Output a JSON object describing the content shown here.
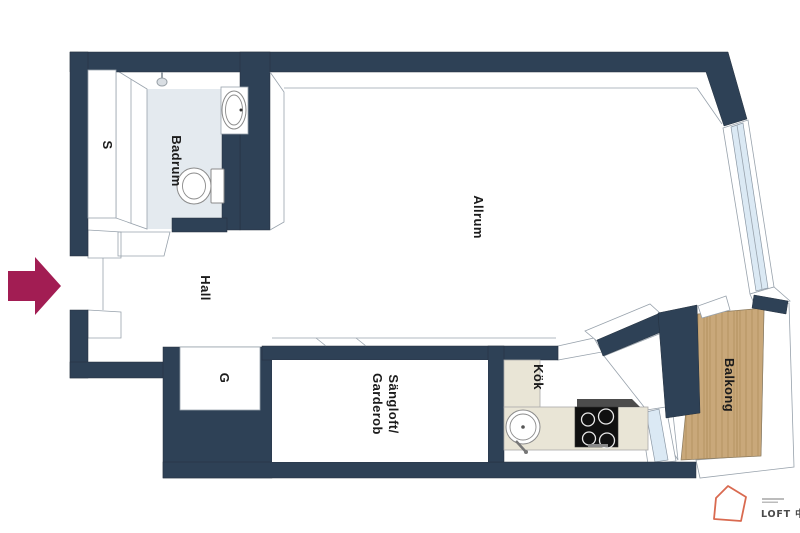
{
  "rooms": {
    "s": {
      "label": "S"
    },
    "badrum": {
      "label": "Badrum"
    },
    "hall": {
      "label": "Hall"
    },
    "allrum": {
      "label": "Allrum"
    },
    "g": {
      "label": "G"
    },
    "sangloft": {
      "label_line1": "Sängloft/",
      "label_line2": "Garderob"
    },
    "kok": {
      "label": "Kök"
    },
    "balkong": {
      "label": "Balkong"
    }
  },
  "logo": {
    "text": "LOFT 中国"
  },
  "colors": {
    "wall": "#2e4156",
    "bathroom_floor": "#e4eaef",
    "kitchen_counter": "#e9e5d6",
    "balcony_wood": "#c9a87a",
    "balcony_wood_stripe": "#b28f5e",
    "window_glass": "#dbe9f4",
    "entry_arrow": "#a21d53",
    "logo_accent": "#d96a50",
    "label_text": "#1b1b1b"
  }
}
